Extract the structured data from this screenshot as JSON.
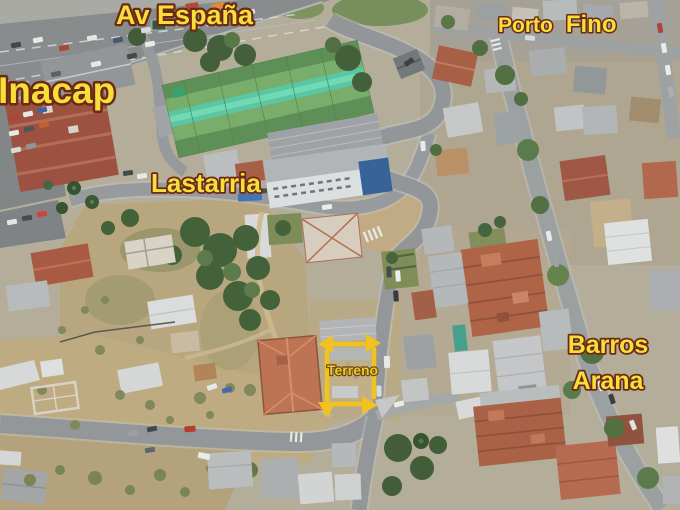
{
  "labels": {
    "av_espana": "Av España",
    "inacap": "Inacap",
    "porto": "Porto",
    "fino": "Fino",
    "lastarria": "Lastarria",
    "barros": "Barros",
    "arana": "Arana"
  },
  "annotation": {
    "terreno": "Terreno",
    "highlight_color": "#F2C21E"
  },
  "colors": {
    "label_yellow": "#F8DE3A",
    "label_outline": "#6B2A14",
    "road_gray": "#8F9396",
    "roof_rust": "#AD5E42",
    "roof_green": "#63995C",
    "roof_teal_stripe": "#55C6A0",
    "dirt_tan": "#BCA87D"
  }
}
